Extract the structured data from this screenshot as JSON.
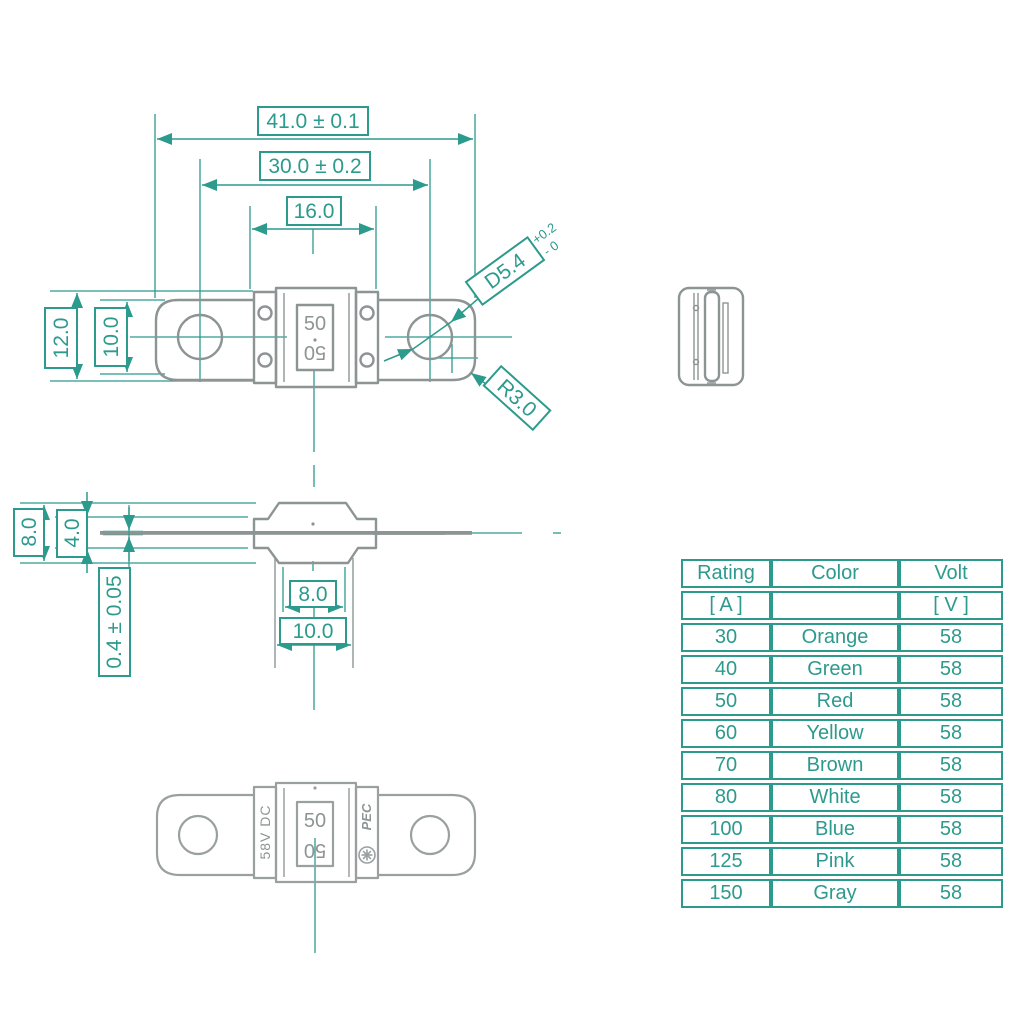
{
  "colors": {
    "teal": "#2c9a8d",
    "gray": "#8d9494"
  },
  "top_view": {
    "overall_length": "41.0 ± 0.1",
    "hole_pitch": "30.0 ± 0.2",
    "body_width": "16.0",
    "terminal_outer_height": "12.0",
    "terminal_inner_height": "10.0",
    "hole_diameter": "D5.4",
    "hole_tol_plus": "+0.2",
    "hole_tol_minus": "- 0",
    "corner_radius": "R3.0",
    "rating_marking": "50"
  },
  "side_view": {
    "body_height": "8.0",
    "inner_height": "4.0",
    "terminal_thickness": "0.4 ± 0.05",
    "boss_width": "8.0",
    "base_width": "10.0"
  },
  "bottom_view": {
    "rating_marking": "50",
    "voltage_marking": "58V DC",
    "brand_marking": "PEC"
  },
  "table": {
    "headers": [
      "Rating",
      "Color",
      "Volt"
    ],
    "units": [
      "[ A ]",
      "",
      "[ V ]"
    ],
    "rows": [
      [
        "30",
        "Orange",
        "58"
      ],
      [
        "40",
        "Green",
        "58"
      ],
      [
        "50",
        "Red",
        "58"
      ],
      [
        "60",
        "Yellow",
        "58"
      ],
      [
        "70",
        "Brown",
        "58"
      ],
      [
        "80",
        "White",
        "58"
      ],
      [
        "100",
        "Blue",
        "58"
      ],
      [
        "125",
        "Pink",
        "58"
      ],
      [
        "150",
        "Gray",
        "58"
      ]
    ]
  }
}
